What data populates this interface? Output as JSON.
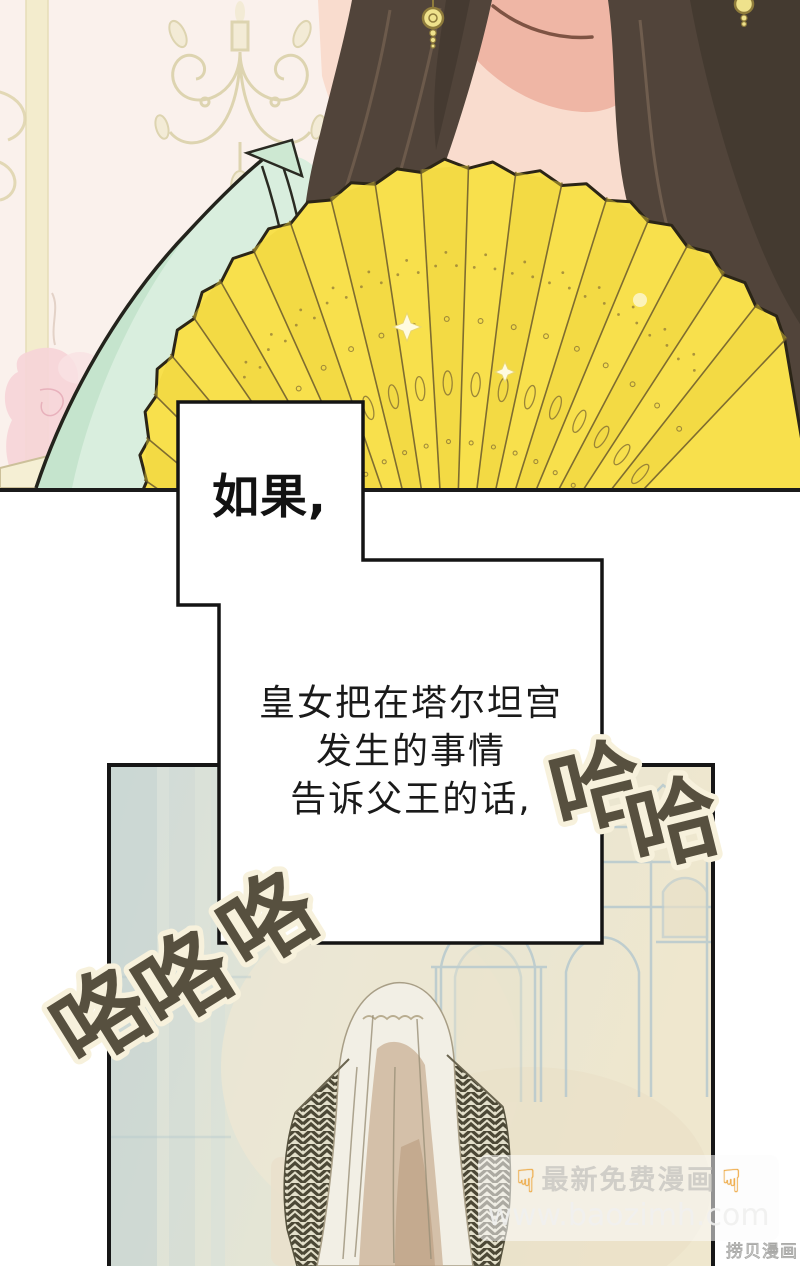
{
  "speech_bubble": {
    "intro": "如果,",
    "line1": "皇女把在塔尔坦宫",
    "line2": "发生的事情",
    "line3": "告诉父王的话,"
  },
  "sfx": {
    "laugh_right_1": "哈",
    "laugh_right_2": "哈",
    "giggle_left_1": "咯",
    "giggle_left_2": "咯",
    "giggle_left_3": "咯"
  },
  "watermark": {
    "hand_icon": "☟",
    "banner": "最新免费漫画",
    "site_url": "www.baozimh.com"
  },
  "corner_credit": "捞贝漫画",
  "colors": {
    "fan_yellow": "#F8E04C",
    "dress_mint": "#D9EEDE",
    "hair_brown": "#51443A",
    "sfx_ink": "#57503F",
    "panel_border": "#1B1B1B",
    "bottom_wash_blue": "#D5DFDA",
    "bottom_wash_beige": "#EFE7CE"
  }
}
